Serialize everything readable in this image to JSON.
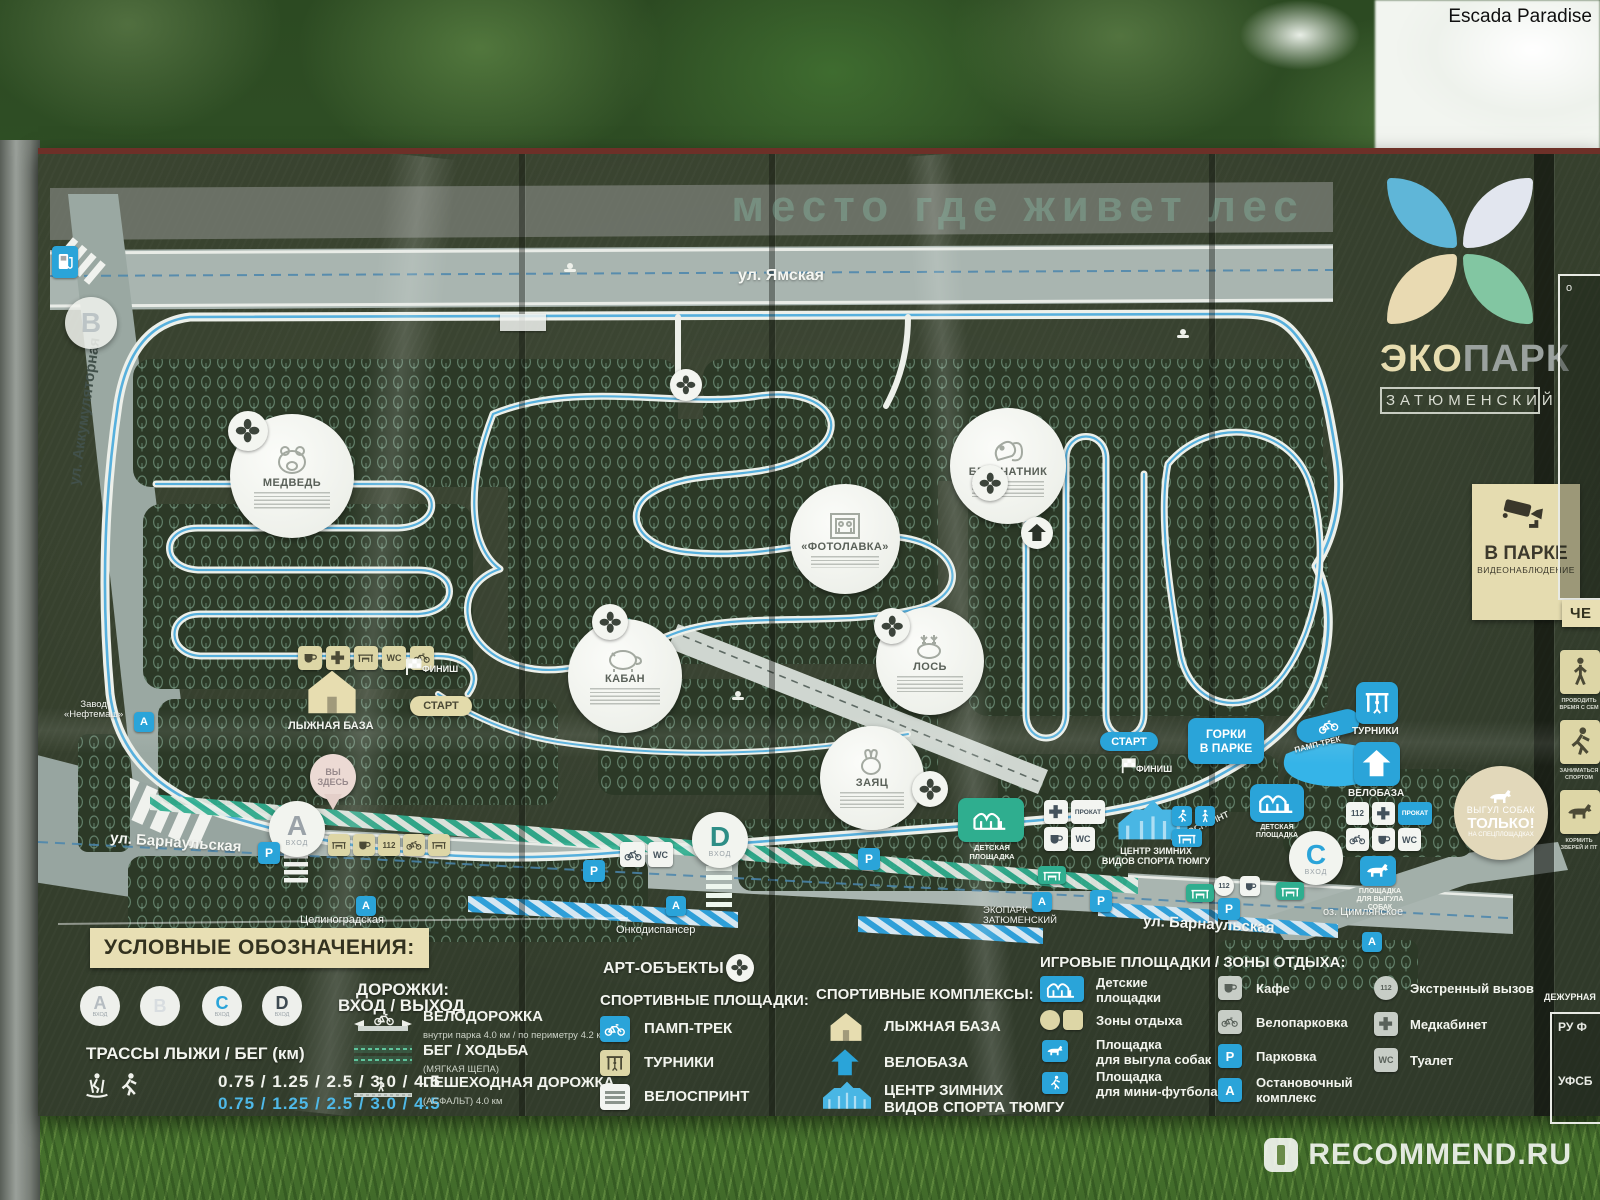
{
  "watermark": {
    "top": "Escada Paradise",
    "bottom": "RECOMMEND.RU"
  },
  "logo": {
    "eco": "ЭКО",
    "park": "ПАРК",
    "sub": "ЗАТЮМЕНСКИЙ"
  },
  "title": "место где живет лес",
  "cctv": {
    "big": "В ПАРКЕ",
    "small": "ВИДЕОНАБЛЮДЕНИЕ"
  },
  "streets": {
    "yamskaya": "ул. Ямская",
    "akkum": "ул. Аккумуляторная",
    "barnaul": "ул. Барнаульская",
    "barnaul2": "ул. Барнаульская",
    "tselinograd": "Целиноградская",
    "onko": "Онкодиспансер",
    "zavod1": "Завод",
    "zavod2": "«Нефтемаш»",
    "stop1": "ЭКОПАРК",
    "stop2": "ЗАТЮМЕНСКИЙ",
    "lake": "оз. Цимлянское"
  },
  "gates": {
    "a": "A",
    "b": "B",
    "c": "C",
    "d": "D",
    "sub": "ВХОД"
  },
  "pois": {
    "bear": "МЕДВЕДЬ",
    "photo": "«ФОТОЛАВКА»",
    "squirrel": "БЕЛЬЧАТНИК",
    "boar": "КАБАН",
    "moose": "ЛОСЬ",
    "hare": "ЗАЯЦ"
  },
  "map": {
    "you1": "ВЫ",
    "you2": "ЗДЕСЬ",
    "start": "СТАРТ",
    "finish": "ФИНИШ",
    "start2": "СТАРТ",
    "finish2": "ФИНИШ",
    "ski_base": "ЛЫЖНАЯ БАЗА",
    "gorki1": "ГОРКИ",
    "gorki2": "В ПАРКЕ",
    "pump": "ПАМП-ТРЕК",
    "sprint": "ВЕЛОСПРИНТ",
    "turniki": "ТУРНИКИ",
    "velobaza": "ВЕЛОБАЗА",
    "kids_a": "ДЕТСКАЯ",
    "kids_b": "ПЛОЩАДКА",
    "kids2_a": "ДЕТСКАЯ",
    "kids2_b": "ПЛОЩАДКА",
    "winter1": "ЦЕНТР ЗИМНИХ",
    "winter2": "ВИДОВ СПОРТА ТЮМГУ",
    "dog1": "ПЛОЩАДКА",
    "dog2": "ДЛЯ ВЫГУЛА",
    "dog3": "СОБАК",
    "notice1": "ВЫГУЛ СОБАК",
    "notice2": "ТОЛЬКО!",
    "notice3": "НА СПЕЦПЛОЩАДКАХ",
    "wc": "WC",
    "p": "P",
    "a": "A",
    "prokat": "ПРОКАТ",
    "sos": "112"
  },
  "legend": {
    "title": "УСЛОВНЫЕ ОБОЗНАЧЕНИЯ:",
    "gate_label": "ВХОД / ВЫХОД",
    "gate_sub": "ВХОД",
    "tracks_title": "ТРАССЫ ЛЫЖИ / БЕГ (км)",
    "tracks1": "0.75 / 1.25 / 2.5 / 3.0 / 4.5",
    "tracks2": "0.75 / 1.25 / 2.5 / 3.0 / 4.5",
    "paths_title": "ДОРОЖКИ:",
    "bike_path": "ВЕЛОДОРОЖКА",
    "bike_sub": "внутри парка 4.0 км  /  по периметру 4.2 км",
    "run_path": "БЕГ / ХОДЬБА",
    "run_sub": "(МЯГКАЯ ЩЕПА)",
    "walk_path": "ПЕШЕХОДНАЯ ДОРОЖКА",
    "walk_sub": "(АСФАЛЬТ) 4.0 км",
    "art": "АРТ-ОБЪЕКТЫ",
    "sport_grounds": "СПОРТИВНЫЕ ПЛОЩАДКИ:",
    "sg1": "ПАМП-ТРЕК",
    "sg2": "ТУРНИКИ",
    "sg3": "ВЕЛОСПРИНТ",
    "sport_complex": "СПОРТИВНЫЕ КОМПЛЕКСЫ:",
    "sc1": "ЛЫЖНАЯ БАЗА",
    "sc2": "ВЕЛОБАЗА",
    "sc3a": "ЦЕНТР ЗИМНИХ",
    "sc3b": "ВИДОВ СПОРТА ТЮМГУ",
    "play": "ИГРОВЫЕ ПЛОЩАДКИ / ЗОНЫ ОТДЫХА:",
    "pl1a": "Детские",
    "pl1b": "площадки",
    "pl2": "Зоны отдыха",
    "pl3a": "Площадка",
    "pl3b": "для выгула собак",
    "pl4a": "Площадка",
    "pl4b": "для мини-футбола",
    "pl5": "Кафе",
    "pl6": "Велопарковка",
    "pl7": "Парковка",
    "pl8a": "Остановочный",
    "pl8b": "комплекс",
    "pl9": "Экстренный вызов",
    "pl10": "Медкабинет",
    "pl11": "Туалет"
  },
  "side": {
    "box": "о",
    "header": "ЧЕ",
    "cap1": "ПРОВОДИТЬ ВРЕМЯ С СЕМ",
    "cap2": "ЗАНИМАТЬСЯ СПОРТОМ",
    "cap3": "КОРМИТЬ ЗВЕРЕЙ И ПТ",
    "duty": "ДЕЖУРНАЯ",
    "b1": "РУ Ф",
    "b2": "УФСБ"
  }
}
